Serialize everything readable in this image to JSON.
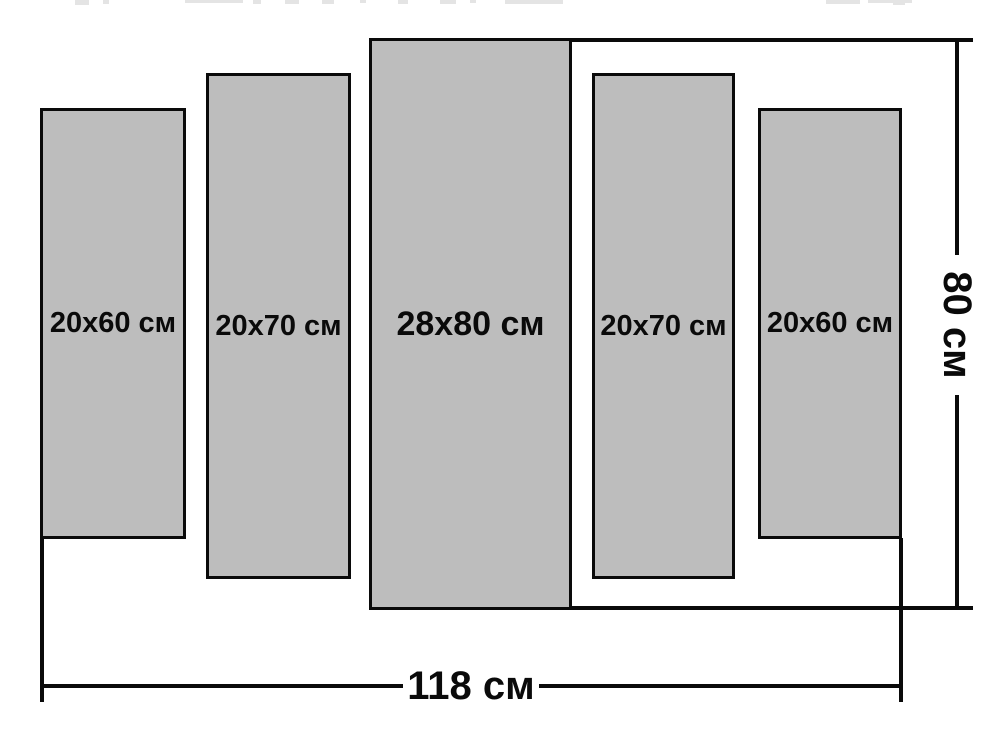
{
  "panels": [
    {
      "label": "20x60 см",
      "width_cm": 20,
      "height_cm": 60
    },
    {
      "label": "20x70 см",
      "width_cm": 20,
      "height_cm": 70
    },
    {
      "label": "28x80 см",
      "width_cm": 28,
      "height_cm": 80
    },
    {
      "label": "20x70 см",
      "width_cm": 20,
      "height_cm": 70
    },
    {
      "label": "20x60 см",
      "width_cm": 20,
      "height_cm": 60
    }
  ],
  "dimensions": {
    "total_width_label": "118 см",
    "total_height_label": "80 см"
  },
  "colors": {
    "background": "#ffffff",
    "panel_fill": "#bdbdbd",
    "line": "#0a0a0a",
    "remnant": "#e4e4e4"
  },
  "top_remnant_fragments": [
    {
      "x": 75,
      "w": 14,
      "h": 5
    },
    {
      "x": 103,
      "w": 6,
      "h": 4
    },
    {
      "x": 185,
      "w": 58,
      "h": 3
    },
    {
      "x": 253,
      "w": 8,
      "h": 4
    },
    {
      "x": 285,
      "w": 14,
      "h": 4
    },
    {
      "x": 322,
      "w": 12,
      "h": 4
    },
    {
      "x": 360,
      "w": 6,
      "h": 3
    },
    {
      "x": 398,
      "w": 10,
      "h": 4
    },
    {
      "x": 440,
      "w": 16,
      "h": 4
    },
    {
      "x": 470,
      "w": 6,
      "h": 3
    },
    {
      "x": 505,
      "w": 58,
      "h": 4
    },
    {
      "x": 826,
      "w": 34,
      "h": 4
    },
    {
      "x": 868,
      "w": 44,
      "h": 3
    },
    {
      "x": 893,
      "w": 12,
      "h": 5
    }
  ]
}
